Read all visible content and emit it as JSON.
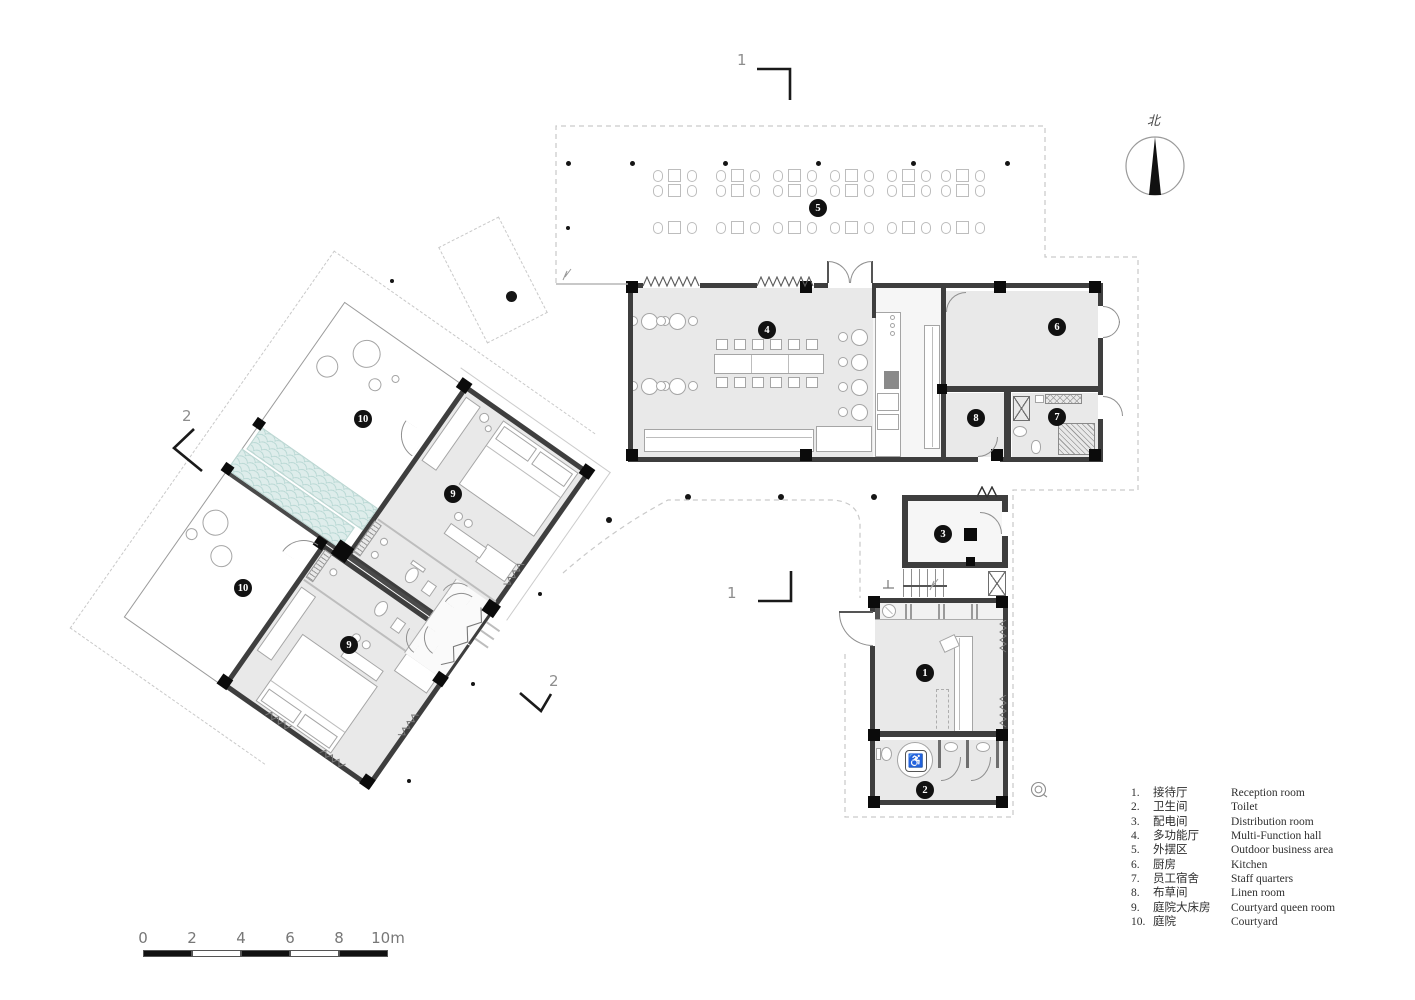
{
  "north": {
    "char": "北"
  },
  "section_marks": {
    "top": "1",
    "bottom": "1",
    "left": "2",
    "bottom_right": "2"
  },
  "scale_bar": {
    "labels": [
      "0",
      "2",
      "4",
      "6",
      "8",
      "10"
    ],
    "unit": "m"
  },
  "legend": {
    "rows": [
      {
        "num": "1.",
        "zh": "接待厅",
        "en": "Reception room"
      },
      {
        "num": "2.",
        "zh": "卫生间",
        "en": "Toilet"
      },
      {
        "num": "3.",
        "zh": "配电间",
        "en": "Distribution room"
      },
      {
        "num": "4.",
        "zh": "多功能厅",
        "en": "Multi-Function hall"
      },
      {
        "num": "5.",
        "zh": "外摆区",
        "en": "Outdoor business area"
      },
      {
        "num": "6.",
        "zh": "厨房",
        "en": "Kitchen"
      },
      {
        "num": "7.",
        "zh": "员工宿舍",
        "en": "Staff quarters"
      },
      {
        "num": "8.",
        "zh": "布草间",
        "en": "Linen room"
      },
      {
        "num": "9.",
        "zh": "庭院大床房",
        "en": "Courtyard queen room"
      },
      {
        "num": "10.",
        "zh": "庭院",
        "en": "Courtyard"
      }
    ]
  },
  "colors": {
    "wall": "#3e3e3e",
    "column": "#0b0b0b",
    "floor": "#e9e9e9",
    "teal": "#deedeb",
    "dash": "#c9c9c9",
    "label_bg": "#111111"
  },
  "plan": {
    "badges": [
      {
        "n": "1",
        "x": 925,
        "y": 673
      },
      {
        "n": "2",
        "x": 925,
        "y": 790
      },
      {
        "n": "3",
        "x": 943,
        "y": 534
      },
      {
        "n": "4",
        "x": 767,
        "y": 330
      },
      {
        "n": "5",
        "x": 818,
        "y": 208
      },
      {
        "n": "6",
        "x": 1057,
        "y": 327
      },
      {
        "n": "7",
        "x": 1057,
        "y": 417
      },
      {
        "n": "8",
        "x": 976,
        "y": 418
      },
      {
        "n": "9",
        "x": 453,
        "y": 494
      },
      {
        "n": "9",
        "x": 349,
        "y": 645
      },
      {
        "n": "10",
        "x": 363,
        "y": 419
      },
      {
        "n": "10",
        "x": 243,
        "y": 588
      }
    ],
    "dots": [
      [
        568,
        163,
        5
      ],
      [
        632,
        163,
        5
      ],
      [
        725,
        163,
        5
      ],
      [
        818,
        163,
        5
      ],
      [
        913,
        163,
        5
      ],
      [
        1007,
        163,
        5
      ],
      [
        568,
        228,
        4
      ],
      [
        392,
        281,
        4
      ],
      [
        511,
        296,
        11
      ],
      [
        540,
        594,
        4
      ],
      [
        473,
        684,
        4
      ],
      [
        409,
        781,
        4
      ],
      [
        609,
        520,
        6
      ],
      [
        688,
        497,
        6
      ],
      [
        781,
        497,
        6
      ],
      [
        874,
        497,
        6
      ]
    ],
    "outdoor_group_xs": [
      675,
      738,
      795,
      852,
      909,
      963
    ],
    "hall_round_tables_left": [
      [
        649,
        321
      ],
      [
        677,
        321
      ],
      [
        649,
        386
      ],
      [
        677,
        386
      ]
    ],
    "hall_round_tables_right": [
      [
        859,
        337
      ],
      [
        859,
        362
      ],
      [
        859,
        387
      ],
      [
        859,
        412
      ]
    ],
    "long_table_chair_xs": [
      716,
      734,
      752,
      770,
      788,
      806
    ],
    "long_table_chair_rows": [
      339,
      377
    ],
    "bar_stools": [
      [
        652,
        443
      ],
      [
        674,
        443
      ],
      [
        696,
        443
      ],
      [
        718,
        443
      ],
      [
        740,
        443
      ]
    ],
    "bar_stools2": [
      [
        824,
        438
      ],
      [
        842,
        438
      ],
      [
        860,
        438
      ]
    ]
  }
}
